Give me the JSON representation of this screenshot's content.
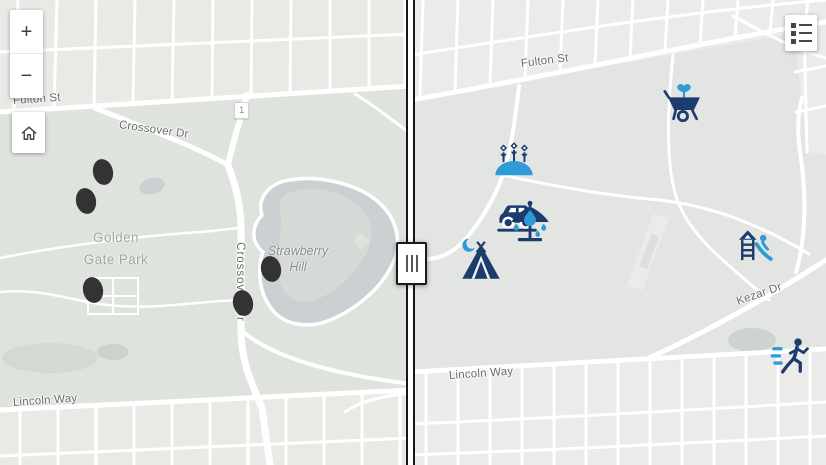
{
  "app": {
    "name": "map-swipe-compare"
  },
  "theme": {
    "icon_navy": "#1d3c6e",
    "icon_accent": "#2e9bd6",
    "marker_color": "#333333",
    "park_fill": "#dfe3dd",
    "water_fill": "#cbd0d3"
  },
  "controls": {
    "zoom_in_label": "+",
    "zoom_out_label": "−",
    "home_icon": "home-icon",
    "legend_icon": "legend-icon",
    "swipe_handle_icon": "drag-handle-icon"
  },
  "left_map": {
    "street_labels": {
      "fulton": "Fulton St",
      "crossover_upper": "Crossover Dr",
      "crossover_lower": "Crossover Dr",
      "lincoln": "Lincoln Way"
    },
    "place_labels": {
      "park_line1": "Golden",
      "park_line2": "Gate Park",
      "hill_line1": "Strawberry",
      "hill_line2": "Hill"
    },
    "route_shield": "1",
    "markers": [
      {
        "x": 103,
        "y": 172
      },
      {
        "x": 86,
        "y": 201
      },
      {
        "x": 93,
        "y": 290
      },
      {
        "x": 271,
        "y": 269
      },
      {
        "x": 243,
        "y": 303
      }
    ]
  },
  "right_map": {
    "street_labels": {
      "fulton": "Fulton St",
      "kezar": "Kezar Dr",
      "lincoln": "Lincoln Way"
    },
    "icons": [
      {
        "name": "garden-flowers-icon",
        "x": 103,
        "y": 161
      },
      {
        "name": "wheelbarrow-icon",
        "x": 273,
        "y": 104
      },
      {
        "name": "car-icon",
        "x": 106,
        "y": 215
      },
      {
        "name": "carousel-icon",
        "x": 119,
        "y": 222
      },
      {
        "name": "tent-icon",
        "x": 70,
        "y": 260
      },
      {
        "name": "playground-slide-icon",
        "x": 345,
        "y": 248
      },
      {
        "name": "runner-icon",
        "x": 381,
        "y": 357
      }
    ]
  }
}
